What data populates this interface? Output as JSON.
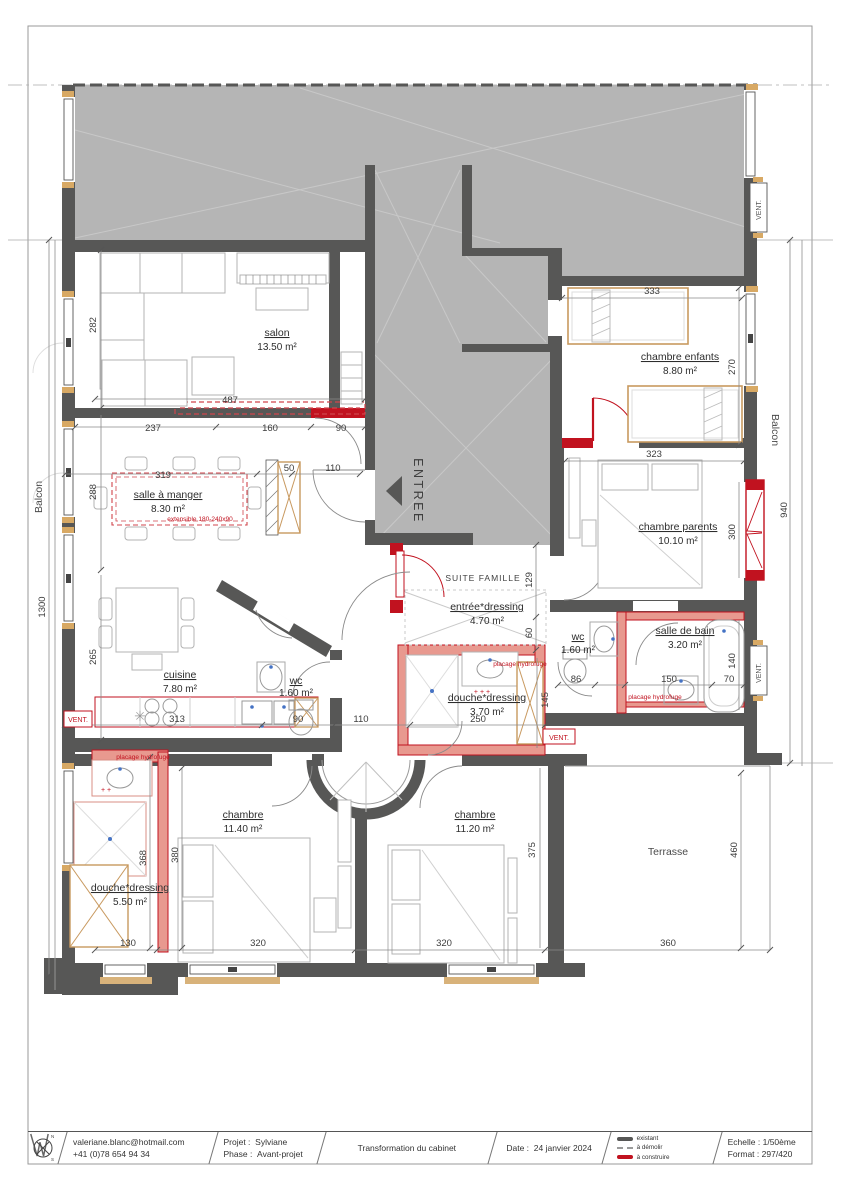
{
  "colors": {
    "wall_existing": "#575756",
    "existing_fill": "#b5b5b5",
    "new_red": "#c1121f",
    "new_wall_fill": "#e8998f",
    "wood": "#c8995f"
  },
  "plan": {
    "rooms": [
      {
        "name": "salon",
        "area": "13.50 m²"
      },
      {
        "name": "chambre enfants",
        "area": "8.80 m²"
      },
      {
        "name": "salle à manger",
        "area": "8.30 m²"
      },
      {
        "name": "chambre parents",
        "area": "10.10 m²"
      },
      {
        "name": "entrée*dressing",
        "area": "4.70 m²"
      },
      {
        "name": "cuisine",
        "area": "7.80 m²"
      },
      {
        "name": "wc",
        "area": "1.60 m²"
      },
      {
        "name": "wc",
        "area": "1.60 m²"
      },
      {
        "name": "salle de bain",
        "area": "3.20 m²"
      },
      {
        "name": "douche*dressing",
        "area": "3.70 m²"
      },
      {
        "name": "chambre",
        "area": "11.40 m²"
      },
      {
        "name": "chambre",
        "area": "11.20 m²"
      },
      {
        "name": "douche*dressing",
        "area": "5.50 m²"
      }
    ],
    "zones": {
      "entree": "ENTREE",
      "suite": "SUITE FAMILLE",
      "balcon": "Balcon",
      "terrasse": "Terrasse",
      "vent": "VENT."
    },
    "annotations": {
      "extensible": "extensible 180-240x90",
      "placage": "placage hydrofuge"
    },
    "dims": [
      "487",
      "237",
      "160",
      "90",
      "319",
      "50",
      "110",
      "282",
      "288",
      "265",
      "1300",
      "333",
      "323",
      "270",
      "300",
      "140",
      "940",
      "129",
      "60",
      "86",
      "150",
      "70",
      "313",
      "90",
      "110",
      "250",
      "145",
      "368",
      "380",
      "375",
      "460",
      "130",
      "320",
      "320",
      "360"
    ]
  },
  "titleblock": {
    "email": "valeriane.blanc@hotmail.com",
    "phone": "+41 (0)78 654 94 34",
    "project_label": "Projet :",
    "project": "Sylviane",
    "phase_label": "Phase :",
    "phase": "Avant-projet",
    "title": "Transformation du cabinet",
    "date_label": "Date :",
    "date": "24 janvier 2024",
    "legend": {
      "existant": "existant",
      "demolir": "à démolir",
      "construire": "à construire"
    },
    "scale_label": "Echelle :",
    "scale": "1/50ème",
    "format_label": "Format :",
    "format": "297/420",
    "compass": {
      "n": "N",
      "s": "S"
    }
  }
}
